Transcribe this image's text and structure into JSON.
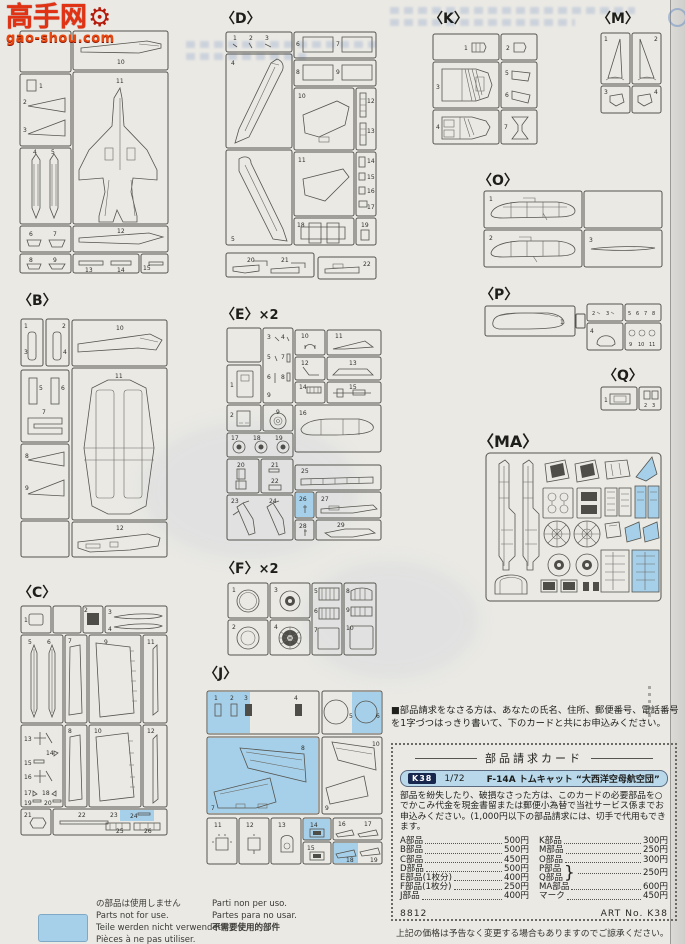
{
  "watermark": {
    "cn": "高手网",
    "site": "gao-shou.com"
  },
  "sprues": {
    "A": {
      "label": "",
      "mult": "",
      "parts": [
        "1",
        "2",
        "3",
        "4",
        "5",
        "6",
        "7",
        "8",
        "9",
        "10",
        "11",
        "12",
        "13",
        "14",
        "15"
      ]
    },
    "B": {
      "label": "〈B〉",
      "mult": "",
      "parts": [
        "1",
        "2",
        "3",
        "4",
        "5",
        "6",
        "7",
        "8",
        "9",
        "10",
        "11",
        "12"
      ]
    },
    "C": {
      "label": "〈C〉",
      "mult": "",
      "parts": [
        "1",
        "2",
        "3",
        "4",
        "5",
        "6",
        "7",
        "8",
        "9",
        "10",
        "11",
        "12",
        "13",
        "14",
        "15",
        "16",
        "17",
        "18",
        "19",
        "20",
        "21",
        "22",
        "23",
        "24",
        "25",
        "26"
      ]
    },
    "D": {
      "label": "〈D〉",
      "mult": "",
      "parts": [
        "1",
        "2",
        "3",
        "4",
        "5",
        "6",
        "7",
        "8",
        "9",
        "10",
        "11",
        "12",
        "13",
        "14",
        "15",
        "16",
        "17",
        "18",
        "19",
        "20",
        "21",
        "22"
      ]
    },
    "E": {
      "label": "〈E〉",
      "mult": "×2",
      "parts": [
        "1",
        "2",
        "3",
        "4",
        "5",
        "6",
        "7",
        "8",
        "9",
        "10",
        "11",
        "12",
        "13",
        "14",
        "15",
        "16",
        "17",
        "18",
        "19",
        "20",
        "21",
        "22",
        "23",
        "24",
        "25",
        "26",
        "27",
        "28",
        "29"
      ]
    },
    "F": {
      "label": "〈F〉",
      "mult": "×2",
      "parts": [
        "1",
        "2",
        "3",
        "4",
        "5",
        "6",
        "7",
        "8",
        "9",
        "10"
      ]
    },
    "J": {
      "label": "〈J〉",
      "mult": "",
      "parts": [
        "1",
        "2",
        "3",
        "4",
        "5",
        "6",
        "7",
        "8",
        "9",
        "10",
        "11",
        "12",
        "13",
        "14",
        "15",
        "16",
        "17",
        "18",
        "19"
      ]
    },
    "K": {
      "label": "〈K〉",
      "mult": "",
      "parts": [
        "1",
        "2",
        "3",
        "4",
        "5",
        "6",
        "7"
      ]
    },
    "M": {
      "label": "〈M〉",
      "mult": "",
      "parts": [
        "1",
        "2",
        "3",
        "4"
      ]
    },
    "O": {
      "label": "〈O〉",
      "mult": "",
      "parts": [
        "1",
        "2",
        "3"
      ]
    },
    "P": {
      "label": "〈P〉",
      "mult": "",
      "parts": [
        "1",
        "2",
        "3",
        "4",
        "5",
        "6",
        "7",
        "8",
        "9",
        "10",
        "11"
      ]
    },
    "Q": {
      "label": "〈Q〉",
      "mult": "",
      "parts": [
        "1",
        "2",
        "3"
      ]
    },
    "MA": {
      "label": "〈MA〉",
      "mult": "",
      "parts": []
    }
  },
  "legend": {
    "highlight_color": "#a6d0ea",
    "col1": [
      "の部品は使用しません",
      "Parts not for use.",
      "Teile werden nicht verwendet.",
      "Pièces à ne pas utiliser."
    ],
    "col2": [
      "Parti non per uso.",
      "Partes para no usar.",
      "不需要使用的部件"
    ]
  },
  "order": {
    "intro": "■部品請求をなさる方は、あなたの氏名、住所、郵便番号、電話番号を1字づつはっきり書いて、下のカードと共にお申込みください。",
    "card_title": "部品請求カード",
    "badge": {
      "code": "K38",
      "scale": "1/72",
      "kit_name": "F-14A トムキャット “大西洋空母航空団”"
    },
    "body": "部品を紛失したり、破損なさった方は、このカードの必要部品を○でかこみ代金を現金書留または郵便小為替で当社サービス係までお申込みください。(1,000円以下の部品請求には、切手で代用もできます。",
    "prices_left": [
      {
        "name": "A部品",
        "price": "500円"
      },
      {
        "name": "B部品",
        "price": "500円"
      },
      {
        "name": "C部品",
        "price": "450円"
      },
      {
        "name": "D部品",
        "price": "500円"
      },
      {
        "name": "E部品(1枚分)",
        "price": "400円"
      },
      {
        "name": "F部品(1枚分)",
        "price": "250円"
      },
      {
        "name": "J部品",
        "price": "400円"
      }
    ],
    "prices_right": [
      {
        "name": "K部品",
        "price": "300円"
      },
      {
        "name": "M部品",
        "price": "250円"
      },
      {
        "name": "O部品",
        "price": "300円"
      }
    ],
    "brace": {
      "name1": "P部品",
      "name2": "Q部品",
      "price": "250円"
    },
    "prices_right2": [
      {
        "name": "MA部品",
        "price": "600円"
      },
      {
        "name": "マーク",
        "price": "450円"
      }
    ],
    "footer_code": "8812",
    "footer_art": "ART No. K38",
    "note": "上記の価格は予告なく変更する場合もありますのでご諒承ください。"
  }
}
